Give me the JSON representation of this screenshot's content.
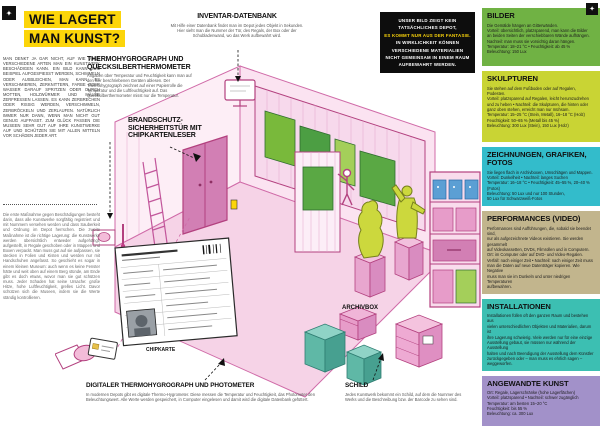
{
  "page": {
    "title_lines": [
      "WIE LAGERT",
      "MAN KUNST?"
    ],
    "corner_glyph_left": "✦",
    "corner_glyph_right": "✦"
  },
  "colors": {
    "accent_yellow": "#fcd50a",
    "pink_outline": "#b3417f",
    "painting_green": "#79b93b",
    "sculpture_green": "#ccd83d"
  },
  "intro": {
    "para1": "MAN DENKT JA GAR NICHT, AUF WIE VIELE VERSCHIEDENE ARTEN MAN EIN KUNSTWERK BESCHÄDIGEN KANN. EIN BILD KANN ZUM BEISPIEL AUFGESPIESST WERDEN, SCHIMMELN ODER AUSBLEICHEN, MAN KANN ES VERSCHMIEREN, ZERKNITTERN, FARBE ODER WASSER DARAUF SPRITZEN ODER DURCH MOTTEN, HOLZWÜRMER UND MÄUSE ZERFRESSEN LASSEN. ES KANN ZERBRECHEN ODER RISSIG WERDEN, VERSCHIMMELN, ZERBRÖCKELN UND ZERLAUFEN. NATÜRLICH IMMER NUR DANN, WENN MAN NICHT GUT GENUG AUFPASST. ZUM GLÜCK PASSEN DIE MUSEEN SEHR GUT AUF IHRE KUNSTWERKE AUF UND SCHÜTZEN SIE MIT ALLEN MITTELN VOR SCHÄDEN JEDER ART.",
    "para2": "Die erste Maßnahme gegen Beschädigungen besteht darin, dass alle Kunstwerke sorgfältig registriert und mit Nummern versehen werden und dass Sauberkeit und Ordnung im Depot herrschen. Die zweite Maßnahme ist die richtige Lagerung: die Kunstwerke werden übersichtlich entweder aufgehängt, aufgestellt, in Regale geschoben oder in Mappen und Boxen verpackt. Man muss gut auf sie aufpassen, sie stecken in Folien und Kisten und werden nur mit Handschuhen angefasst. So geschieht es sogar in einem kleinen Museum: auch wenn es keine Fenster hätte und weit oben auf einem Berg stünde, am Ende gibt es doch etwas, wovor man sie gut schützen muss. Jeder Schaden hat seine Ursache: große Hitze, hohe Luftfeuchtigkeit, grelles Licht. Davor schützen sich die Museen, indem sie die Werte ständig kontrollieren."
  },
  "annotations": {
    "inventar": {
      "heading": "INVENTAR-DATENBANK",
      "body": "Mit Hilfe einer Datenbank findet man im Depot jedes Objekt in Sekunden. Hier sieht man die Nummer der Tür, des Regals, der Box oder der Schubladenwand, wo das Werk aufbewahrt wird."
    },
    "thermo": {
      "heading": "THERMOHYGROGRAPH UND QUECKSILBERTHERMOMETER",
      "body": "Angaben über Temperatur und Feuchtigkeit kann man auf den hier beschriebenen Geräten ablesen. Der Thermohygrograph zeichnet auf einer Papierrolle die Temperatur und die Luftfeuchtigkeit auf. Das Quecksilberthermometer misst nur die Temperatur."
    },
    "brandschutz": {
      "heading": "BRANDSCHUTZ-SICHERHEITSTÜR MIT CHIPKARTENLESER"
    },
    "digital": {
      "heading": "DIGITALER THERMOHYGROGRAPH UND PHOTOMETER",
      "body": "In modernen Depots gibt es digitale Thermo-Hygrometer. Diese messen die Temperatur und Feuchtigkeit, das Photometer den Beleuchtungswert. Alle Werte werden gespeichert, in Computer eingelesen und damit wird die digitale Datenbank gefüttert."
    },
    "schild": {
      "heading": "SCHILD",
      "body": "Jedes Kunstwerk bekommt ein Schild, auf dem die Nummer des Werks und die Beschreibung bzw. der Barcode zu sehen sind."
    },
    "archivbox_label": "ARCHIVBOX",
    "chipkarte_label": "CHIPKARTE"
  },
  "notice": {
    "lines": [
      "UNSER BILD ZEIGT KEIN",
      "TATSÄCHLICHES DEPOT,",
      "ES KOMMT NUR AUS DER FANTASIE.",
      "IN WIRKLICHKEIT KÖNNEN",
      "VERSCHIEDENE MATERIALIEN",
      "NICHT GEMEINSAM IN EINEM RAUM",
      "AUFBEWAHRT WERDEN."
    ]
  },
  "sidebar": {
    "sections": [
      {
        "heading": "BILDER",
        "bg": "#70b244",
        "lines": [
          "Die Gemälde hängen an Gitterwänden.",
          "Vorteil: übersichtlich, platzsparend, man kann die Bilder",
          "an beiden Seiten der verschiebbaren Wände aufhängen.",
          "Nachteil: man muss sie vorsichtig daran hängen.",
          "Temperatur: 18–21 °C • Feuchtigkeit: ab 45 %",
          "Beleuchtung: 150 Lux"
        ]
      },
      {
        "heading": "SKULPTUREN",
        "bg": "#c9d434",
        "lines": [
          "Sie stehen auf dem Fußboden oder auf Regalen, Podesten.",
          "Vorteil: platzsparend auf Regalen, leicht herumzudrehen",
          "und zu heben • Nachteil: die Skulpturen, die hinten oder",
          "ganz oben stehen, erreicht man nur mühsam.",
          "Temperatur: 15–25 °C (Stein, Metall), 16–18 °C (Holz)",
          "Feuchtigkeit: 50–65 % (Metall bis 45 %)",
          "Beleuchtung: 300 Lux (Stein), 150 Lux (Holz)"
        ]
      },
      {
        "heading": "ZEICHNUNGEN, GRAFIKEN, FOTOS",
        "bg": "#33bccb",
        "lines": [
          "Sie liegen flach in Archivboxen, Umschlägen und Mappen.",
          "Vorteil: Dunkelheit • Nachteil: langes Suchen",
          "Temperatur: 16–18 °C • Feuchtigkeit: 45–55 %, 20–40 % (Fotos)",
          "Beleuchtung: 50 Lux und nur 100 Stunden,",
          "50 Lux für Schwarzweiß-Fotos"
        ]
      },
      {
        "heading": "PERFORMANCES (VIDEO)",
        "bg": "#c2b58d",
        "lines": [
          "Performances sind Aufführungen, die, sobald sie beendet sind,",
          "nur als aufgezeichnete Videos existieren. Sie werden gesammelt",
          "auf Videokassetten, DVDs, Filmrollen und in Computern.",
          "Ort: im Computer oder auf DVD- und Video-Regalen.",
          "Verfall: nach einiger Zeit • Nachteil: nach einiger Zeit muss",
          "man die Daten auf neue Datenträger kopieren. Wie Negative",
          "muss man sie im Dunkeln und unter niedrigen Temperaturen",
          "aufbewahren."
        ]
      },
      {
        "heading": "INSTALLATIONEN",
        "bg": "#3cbfb2",
        "lines": [
          "Installationen füllen oft den ganzen Raum und bestehen aus",
          "vielen unterschiedlichen Objekten und Materialien, darum ist",
          "ihre Lagerung schwierig. Viele werden nur für eine einzige",
          "Ausstellung gebaut, sie müssen nur während der Ausstellung",
          "halten und nach Beendigung der Ausstellung dem Künstler",
          "zurückgegeben oder – man muss es ehrlich sagen – weggeworfen."
        ]
      },
      {
        "heading": "ANGEWANDTE KUNST",
        "bg": "#a291c9",
        "lines": [
          "Ort: Regale, Lagerschränke (hohe Lagerflächen)",
          "Vorteil: platzsparend • Nachteil: schwer zugänglich",
          "Temperatur: am besten 15–20 °C",
          "Feuchtigkeit: bis 55 %",
          "Beleuchtung: ca. 300 Lux"
        ]
      }
    ]
  }
}
